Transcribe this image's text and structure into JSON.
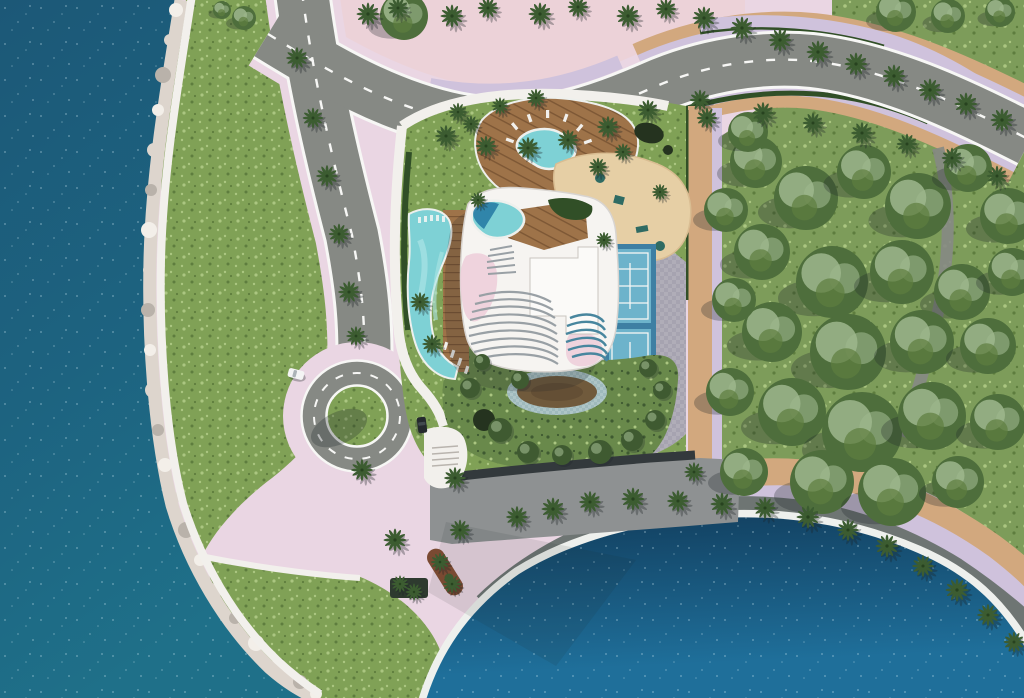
{
  "meta": {
    "title": "Aerial site-plan rendering of waterfront tower development",
    "type": "architectural-render",
    "view": "top-down aerial"
  },
  "scene": {
    "description": "Photorealistic top-down rendering of a coastal residential development: deep blue sea with rocky shoreline on the left, curving access road leading to a landscaped roundabout, a white organic-shaped tower roof with rooftop pool and louvers, free-form swimming pool, timber decks, kids splash pool, sand playground, twin sport courts, gardens with a reflecting pond, pink paved promenades, a palm-lined waterfront esplanade and a large lagoon at the bottom right, with a dense green park on the right.",
    "elements": [
      "ocean",
      "rocky-shoreline",
      "coastal-path",
      "lawn",
      "access-road",
      "top-road",
      "roundabout",
      "drop-off-stub",
      "crosswalk",
      "amenity-podium",
      "timber-deck",
      "splash-pool",
      "sun-loungers",
      "playground-sand",
      "play-equipment",
      "paver-path",
      "sport-courts",
      "tower-roof",
      "rooftop-pool",
      "roof-louvers",
      "main-pool",
      "pool-deck",
      "garden",
      "reflecting-pond",
      "site-wall",
      "entry-steps",
      "pink-plaza",
      "planters",
      "palm-trees",
      "park-forest",
      "waterfront-promenade",
      "lagoon",
      "cars"
    ],
    "palms": [
      [
        368,
        14,
        1
      ],
      [
        398,
        8,
        0.9
      ],
      [
        452,
        16,
        1
      ],
      [
        488,
        8,
        0.9
      ],
      [
        540,
        14,
        1
      ],
      [
        578,
        7,
        0.9
      ],
      [
        628,
        16,
        1
      ],
      [
        666,
        9,
        0.9
      ],
      [
        704,
        18,
        1
      ],
      [
        742,
        28,
        1
      ],
      [
        780,
        40,
        1
      ],
      [
        818,
        52,
        1
      ],
      [
        856,
        64,
        1
      ],
      [
        894,
        76,
        1
      ],
      [
        930,
        90,
        1
      ],
      [
        966,
        104,
        1
      ],
      [
        1002,
        120,
        1
      ],
      [
        446,
        136,
        0.95
      ],
      [
        486,
        146,
        0.9
      ],
      [
        528,
        148,
        0.95
      ],
      [
        568,
        140,
        0.9
      ],
      [
        608,
        127,
        0.95
      ],
      [
        648,
        110,
        0.9
      ],
      [
        700,
        100,
        0.9
      ],
      [
        763,
        113,
        0.95
      ],
      [
        813,
        123,
        0.9
      ],
      [
        862,
        133,
        0.95
      ],
      [
        907,
        144,
        0.9
      ],
      [
        952,
        158,
        0.9
      ],
      [
        997,
        176,
        0.9
      ],
      [
        297,
        58,
        0.95
      ],
      [
        313,
        118,
        0.9
      ],
      [
        327,
        176,
        0.95
      ],
      [
        339,
        234,
        0.9
      ],
      [
        349,
        292,
        0.95
      ],
      [
        356,
        336,
        0.85
      ],
      [
        420,
        302,
        0.85
      ],
      [
        432,
        344,
        0.85
      ],
      [
        362,
        470,
        0.95
      ],
      [
        395,
        540,
        1
      ],
      [
        455,
        478,
        0.95
      ],
      [
        460,
        530,
        0.9
      ],
      [
        440,
        562,
        0.8
      ],
      [
        452,
        584,
        0.8
      ],
      [
        400,
        584,
        0.75
      ],
      [
        414,
        592,
        0.75
      ],
      [
        517,
        517,
        0.95
      ],
      [
        553,
        509,
        1
      ],
      [
        590,
        502,
        0.95
      ],
      [
        633,
        499,
        1
      ],
      [
        678,
        501,
        0.95
      ],
      [
        722,
        504,
        1
      ],
      [
        765,
        508,
        0.95
      ],
      [
        808,
        517,
        1
      ],
      [
        848,
        530,
        0.95
      ],
      [
        887,
        546,
        1
      ],
      [
        923,
        566,
        0.95
      ],
      [
        957,
        590,
        1
      ],
      [
        988,
        615,
        0.95
      ],
      [
        1014,
        642,
        0.9
      ],
      [
        707,
        118,
        0.9
      ],
      [
        694,
        472,
        0.85
      ],
      [
        458,
        112,
        0.8
      ],
      [
        471,
        124,
        0.75
      ],
      [
        478,
        200,
        0.7
      ],
      [
        598,
        167,
        0.8
      ],
      [
        623,
        152,
        0.75
      ],
      [
        660,
        192,
        0.7
      ],
      [
        604,
        240,
        0.7
      ],
      [
        536,
        98,
        0.8
      ],
      [
        500,
        106,
        0.75
      ]
    ],
    "trees": [
      [
        404,
        16,
        24
      ],
      [
        756,
        162,
        26
      ],
      [
        806,
        198,
        32
      ],
      [
        864,
        172,
        27
      ],
      [
        918,
        206,
        33
      ],
      [
        968,
        168,
        24
      ],
      [
        1008,
        216,
        28
      ],
      [
        762,
        252,
        28
      ],
      [
        832,
        282,
        36
      ],
      [
        902,
        272,
        32
      ],
      [
        962,
        292,
        28
      ],
      [
        1012,
        272,
        24
      ],
      [
        772,
        332,
        30
      ],
      [
        848,
        352,
        38
      ],
      [
        922,
        342,
        32
      ],
      [
        988,
        346,
        28
      ],
      [
        792,
        412,
        34
      ],
      [
        862,
        432,
        40
      ],
      [
        932,
        416,
        34
      ],
      [
        998,
        422,
        28
      ],
      [
        822,
        482,
        32
      ],
      [
        892,
        492,
        34
      ],
      [
        958,
        482,
        26
      ],
      [
        744,
        472,
        24
      ],
      [
        730,
        392,
        24
      ],
      [
        734,
        300,
        22
      ],
      [
        726,
        210,
        22
      ],
      [
        748,
        132,
        20
      ],
      [
        896,
        12,
        20
      ],
      [
        948,
        16,
        17
      ],
      [
        1000,
        12,
        15
      ],
      [
        244,
        18,
        12
      ],
      [
        222,
        10,
        9
      ]
    ],
    "shrubs": [
      [
        470,
        388,
        10
      ],
      [
        500,
        430,
        12
      ],
      [
        528,
        452,
        11
      ],
      [
        562,
        455,
        10
      ],
      [
        600,
        452,
        12
      ],
      [
        632,
        440,
        11
      ],
      [
        655,
        420,
        10
      ],
      [
        662,
        390,
        9
      ],
      [
        520,
        380,
        9
      ],
      [
        482,
        362,
        8
      ],
      [
        648,
        368,
        9
      ]
    ],
    "rocks": [
      [
        176,
        10,
        7
      ],
      [
        170,
        40,
        6
      ],
      [
        163,
        75,
        8
      ],
      [
        158,
        110,
        6
      ],
      [
        154,
        150,
        7
      ],
      [
        151,
        190,
        6
      ],
      [
        149,
        230,
        8
      ],
      [
        149,
        270,
        6
      ],
      [
        148,
        310,
        7
      ],
      [
        150,
        350,
        6
      ],
      [
        153,
        390,
        8
      ],
      [
        158,
        430,
        6
      ],
      [
        165,
        465,
        7
      ],
      [
        174,
        498,
        6
      ],
      [
        186,
        530,
        8
      ],
      [
        200,
        560,
        6
      ],
      [
        216,
        590,
        7
      ],
      [
        235,
        618,
        6
      ],
      [
        256,
        643,
        8
      ],
      [
        278,
        664,
        6
      ],
      [
        300,
        682,
        7
      ],
      [
        316,
        694,
        6
      ]
    ],
    "cars": [
      {
        "x": 296,
        "y": 374,
        "angle": 15,
        "color": "white"
      },
      {
        "x": 422,
        "y": 425,
        "angle": 83,
        "color": "dark"
      }
    ]
  },
  "palette": {
    "ocean_deep": "#1c5877",
    "ocean_mid": "#1d6380",
    "ocean_teal": "#1f7089",
    "lagoon_dark": "#123f5f",
    "lagoon_bright": "#1f6f9a",
    "sparkle": "#cfe9f2",
    "shore_rock": "#ddd5cd",
    "rock_light": "#f3efe9",
    "rock_shadow": "#b9b2aa",
    "path_white": "#f2f0ec",
    "curb": "#eef0ed",
    "lawn": "#80a156",
    "lawn_light": "#abc681",
    "lawn_dark": "#5e7d3e",
    "park_green": "#7d9c5a",
    "garden": "#69894b",
    "garden_dark": "#3f5a31",
    "tree_dark": "#4e6e3c",
    "tree_light": "#9fb78d",
    "palm_green": "#3c5c31",
    "palm_dark": "#27421f",
    "hedge": "#314f27",
    "road": "#868984",
    "road_white": "#f7f7f5",
    "plaza_pink": "#ead6e3",
    "plaza_salmon": "#ecd2d8",
    "lavender": "#cfc2dc",
    "tan": "#d2a87e",
    "sand": "#e6cfa5",
    "sand_edge": "#d9bd92",
    "paver": "#b0adb8",
    "paver_dark": "#93909f",
    "promenade": "#6e7573",
    "wall": "#33393c",
    "pavement": "#8e9192",
    "wood": "#9e7349",
    "wood_dark": "#7d5735",
    "pool": "#7ed1d5",
    "pool_light": "#abe4e5",
    "pool_deep": "#2278a2",
    "roof": "#f6f4f1",
    "roof_edge": "#d8d4d0",
    "roof_pink": "#edccd9",
    "louver_gray": "#99a0a5",
    "louver_teal": "#48869e",
    "court": "#6db3cb",
    "court_dark": "#3e7fa3",
    "pond_brown": "#705a3c",
    "pond_ring": "#aec5c7",
    "pond_dark": "#25331f",
    "play_teal": "#2f6b63",
    "play_brown": "#6e4f33",
    "shadow": "#1c2326",
    "car_white": "#f4f4f4",
    "car_dark": "#24292d"
  }
}
